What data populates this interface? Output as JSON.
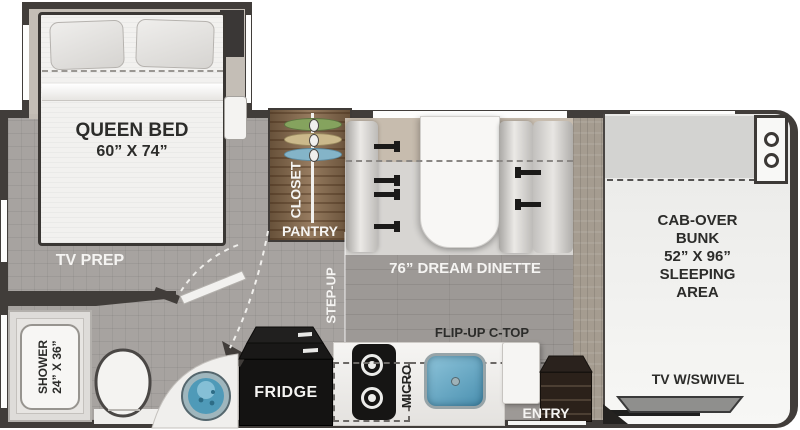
{
  "labels": {
    "bedroom": {
      "bed_line1": "QUEEN BED",
      "bed_line2": "60” X 74”",
      "tv_prep": "TV PREP"
    },
    "bathroom": {
      "shower_line1": "SHOWER",
      "shower_line2": "24” X 36”"
    },
    "storage": {
      "closet": "CLOSET",
      "pantry": "PANTRY"
    },
    "living": {
      "step_up": "STEP-UP",
      "dinette": "76” DREAM DINETTE"
    },
    "kitchen": {
      "fridge": "FRIDGE",
      "micro": "MICRO",
      "flip_up_ctop": "FLIP-UP C-TOP",
      "entry": "ENTRY"
    },
    "cab": {
      "bunk_lines": [
        "CAB-OVER",
        "BUNK",
        "52” X 96”",
        "SLEEPING",
        "AREA"
      ],
      "tv": "TV W/SWIVEL"
    }
  },
  "colors": {
    "wall": "#413d3a",
    "carpet_floor": "#a7a3a0",
    "plank_floor": "#9d9996",
    "closet_wood": "#8a6c4d",
    "sink_blue": "#4a90b0",
    "hanger_green": "#85a35e",
    "hanger_tan": "#cbb98b",
    "hanger_blue": "#84b4c8",
    "fridge_black": "#141312",
    "entry_brown": "#2b211a"
  }
}
